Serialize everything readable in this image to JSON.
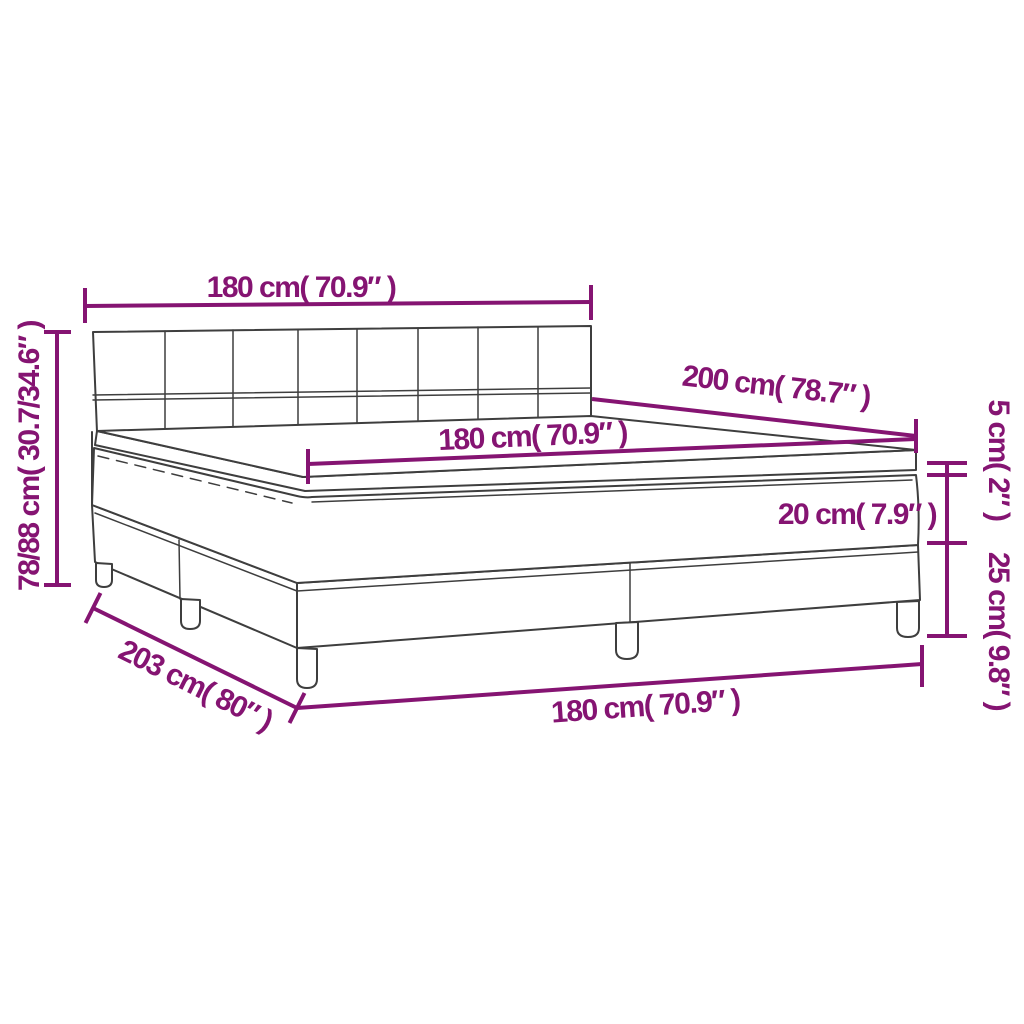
{
  "colors": {
    "dimension_accent": "#851472",
    "drawing_outline": "#3E3E3E",
    "background": "#FFFFFF"
  },
  "dimension_labels": {
    "headboard_width_top": "180 cm( 70.9″ )",
    "overall_height_left": "78/88 cm( 30.7/34.6″ )",
    "bed_length": "200 cm( 78.7″ )",
    "mattress_width": "180 cm( 70.9″ )",
    "mattress_thickness": "20 cm( 7.9″ )",
    "topper_thickness": "5 cm( 2″ )",
    "base_height": "25 cm( 9.8″ )",
    "overall_length_bottom": "203 cm( 80″ )",
    "bed_width_bottom": "180 cm( 70.9″ )"
  }
}
